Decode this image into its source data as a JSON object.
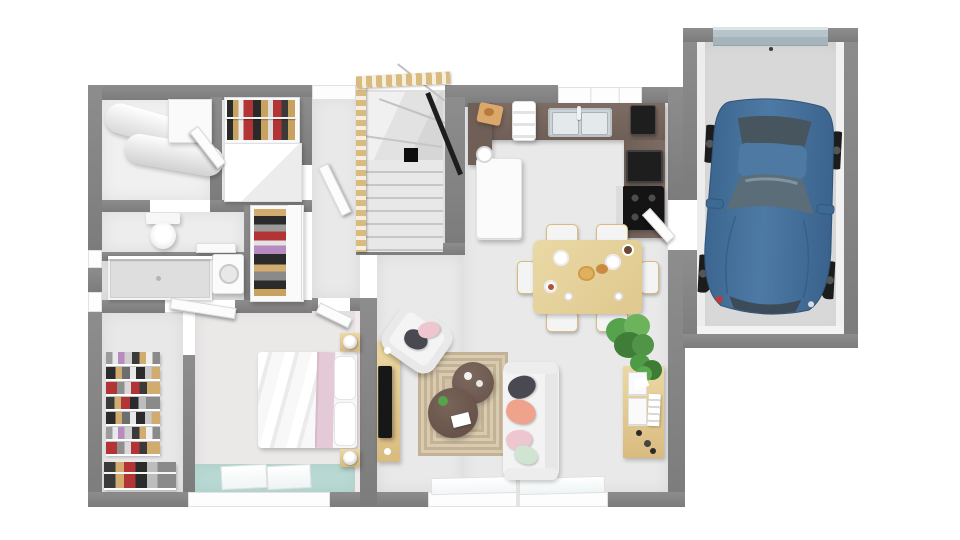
{
  "meta": {
    "kind": "3d-floor-plan-top-view-render",
    "rooms": [
      "utility-room",
      "hall-closet",
      "wc",
      "bathroom",
      "hallway",
      "staircase",
      "kitchen",
      "dining-area",
      "living-room",
      "bedroom",
      "walk-in-closet",
      "garage"
    ],
    "objects": [
      "water-heater-cylinders",
      "hanging-clothes-rack",
      "toilet",
      "walk-in-shower",
      "washing-machine",
      "open-wardrobe",
      "wood-staircase-with-railing",
      "u-shaped-kitchen-counter",
      "double-sink",
      "coffee-machine",
      "built-in-oven",
      "cooktop",
      "refrigerator",
      "dining-table-with-six-chairs",
      "breakfast-table-setting",
      "tv-sideboard",
      "television",
      "armchair",
      "area-rug",
      "round-coffee-tables",
      "sofa-with-cushions",
      "potted-plants",
      "desk-shelf-unit",
      "double-bed",
      "nightstands-with-lamps",
      "closet-shelving",
      "blue-car",
      "sectional-garage-door",
      "interior-doors",
      "windows"
    ]
  },
  "palette": {
    "background": "#ffffff",
    "wall": "#7c7c7c",
    "wall_hi": "#8d8d8d",
    "floor": "#e9e9e9",
    "floor_bed": "#ebe8e8",
    "floor_util": "#f0f0f0",
    "teal": "#b9dad4",
    "counter": "#6f5f57",
    "counter_hi": "#7d6c63",
    "wood": "#ecd8a4",
    "wood_dark": "#d9bb80",
    "rug": "#cfc2a6",
    "rug_line": "#c0b08f",
    "car_body": "#44719b",
    "car_dark": "#33597e",
    "car_glass": "#55666f",
    "white_furniture": "#f6f6f6",
    "appliance": "#1e1e1e",
    "steel": "#ccd4d8",
    "plant_green": "#57a24c",
    "plant_dark": "#3f7d38",
    "pillow_dark": "#494951",
    "pillow_coral": "#efa28c",
    "pillow_pink": "#eec6cf",
    "pillow_mint": "#cfe5d1",
    "bed_throw": "#e4cad6",
    "garage_floor": "#d8d8d8",
    "garage_door": "#b7c4c9",
    "table_wood": "#ead9a6",
    "dark_table": "#6e5950"
  }
}
